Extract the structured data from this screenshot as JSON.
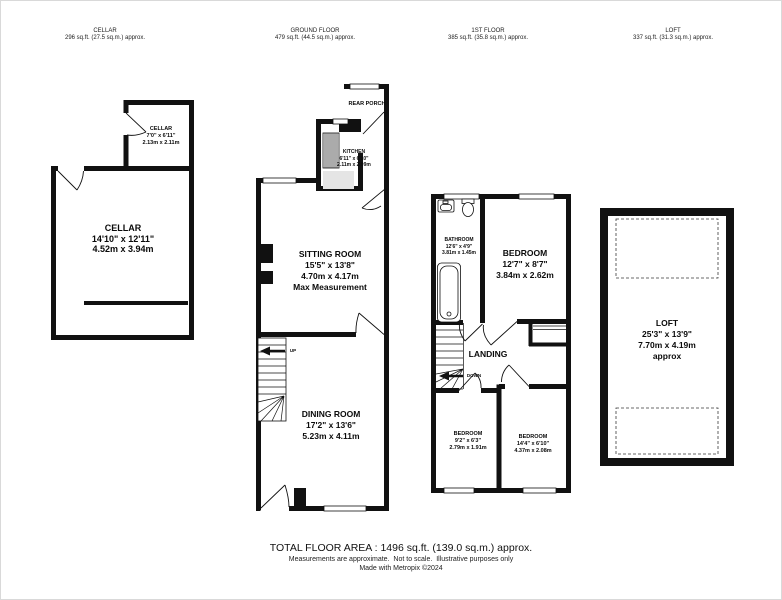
{
  "headers": [
    {
      "title": "CELLAR",
      "area": "296 sq.ft. (27.5 sq.m.) approx."
    },
    {
      "title": "GROUND FLOOR",
      "area": "479 sq.ft. (44.5 sq.m.) approx."
    },
    {
      "title": "1ST FLOOR",
      "area": "385 sq.ft. (35.8 sq.m.) approx."
    },
    {
      "title": "LOFT",
      "area": "337 sq.ft. (31.3 sq.m.) approx."
    }
  ],
  "rooms": {
    "cellar_small": {
      "name": "CELLAR",
      "imperial": "7'0\" x 6'11\"",
      "metric": "2.13m x 2.11m"
    },
    "cellar_main": {
      "name": "CELLAR",
      "imperial": "14'10\" x 12'11\"",
      "metric": "4.52m x 3.94m"
    },
    "rear_porch": {
      "name": "REAR PORCH"
    },
    "kitchen": {
      "name": "KITCHEN",
      "imperial": "6'11\" x 6'10\"",
      "metric": "2.11m x 2.09m"
    },
    "sitting_room": {
      "name": "SITTING ROOM",
      "imperial": "15'5\" x 13'8\"",
      "metric": "4.70m x 4.17m",
      "note": "Max Measurement"
    },
    "dining_room": {
      "name": "DINING ROOM",
      "imperial": "17'2\" x 13'6\"",
      "metric": "5.23m x 4.11m"
    },
    "bathroom": {
      "name": "BATHROOM",
      "imperial": "12'6\" x 4'9\"",
      "metric": "3.81m x 1.45m"
    },
    "bedroom_1": {
      "name": "BEDROOM",
      "imperial": "12'7\" x 8'7\"",
      "metric": "3.84m x 2.62m"
    },
    "landing": {
      "name": "LANDING"
    },
    "bedroom_2": {
      "name": "BEDROOM",
      "imperial": "9'2\" x 6'3\"",
      "metric": "2.79m x 1.91m"
    },
    "bedroom_3": {
      "name": "BEDROOM",
      "imperial": "14'4\" x 6'10\"",
      "metric": "4.37m x 2.08m"
    },
    "loft_room": {
      "name": "LOFT",
      "imperial": "25'3\" x 13'9\"",
      "metric": "7.70m x 4.19m",
      "note": "approx"
    }
  },
  "stairs": {
    "up": "UP",
    "down": "DOWN"
  },
  "footer": {
    "total": "TOTAL FLOOR AREA : 1496 sq.ft. (139.0 sq.m.) approx.",
    "disclaimer": "Measurements are approximate.  Not to scale.  Illustrative purposes only",
    "credit": "Made with Metropix ©2024"
  },
  "colors": {
    "wall": "#111111",
    "kitchen_floor": "#e5e5e5",
    "background": "#ffffff"
  }
}
